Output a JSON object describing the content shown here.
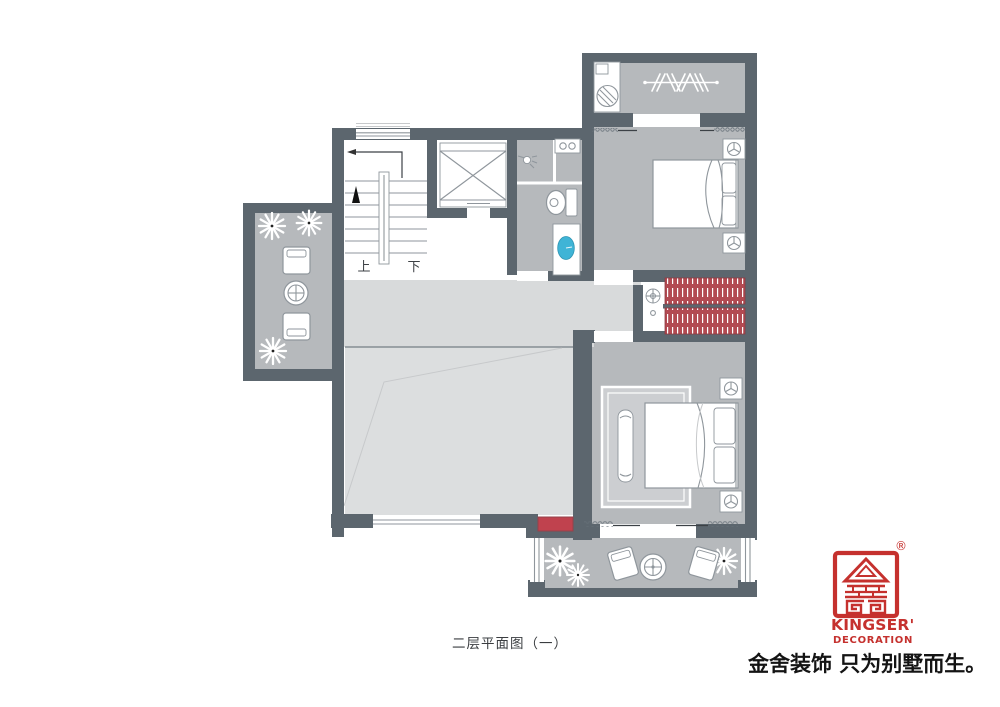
{
  "plan": {
    "caption": "二层平面图（一）",
    "stair_up_label": "上",
    "stair_down_label": "下"
  },
  "branding": {
    "logo_line1": "KINGSER'",
    "logo_line2": "DECORATION",
    "registered": "®",
    "slogan": "金舍装饰 只为别墅而生。"
  },
  "colors": {
    "wall": "#5c666e",
    "room": "#b6b9bc",
    "corridor": "#d8dadb",
    "void": "#dcdedf",
    "accent_red": "#c0424e",
    "wardrobe_red": "#b24a52",
    "sink_blue": "#3fb4d6",
    "logo_red": "#c5312e",
    "line": "#8f969c"
  },
  "icons": [
    "washing-machine-icon",
    "clothes-rack-icon",
    "shower-head-icon",
    "toilet-icon",
    "basin-counter-icon",
    "vanity-sink-icon",
    "elevator-icon",
    "stairs-icon",
    "hvac-fan-icon",
    "plant-icon",
    "armchair-icon",
    "round-table-icon",
    "double-bed-icon",
    "wardrobe-icon",
    "bench-icon",
    "console-table-icon",
    "kingser-logo-icon"
  ]
}
